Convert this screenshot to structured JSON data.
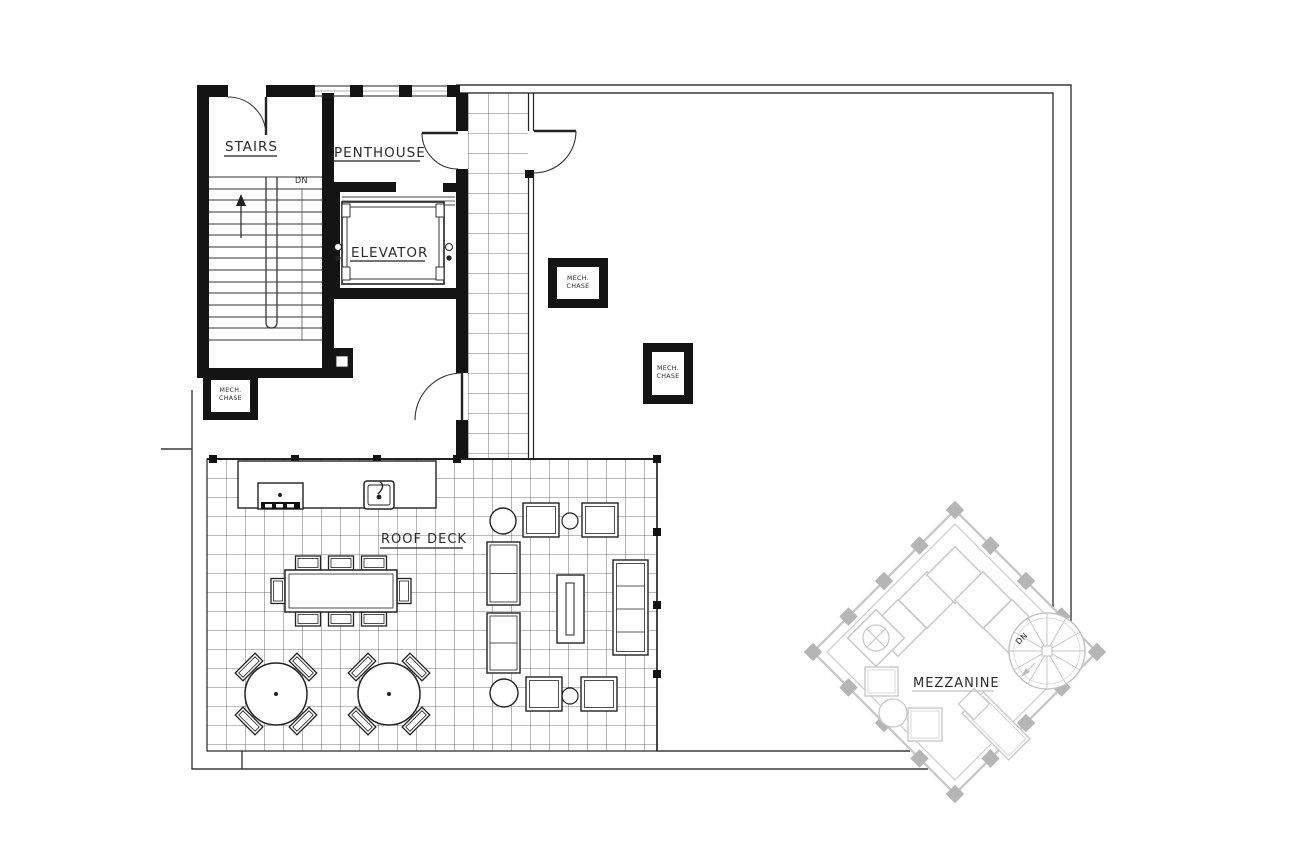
{
  "plan": {
    "labels": {
      "stairs": "STAIRS",
      "penthouse": "PENTHOUSE",
      "elevator": "ELEVATOR",
      "roof_deck": "ROOF DECK",
      "mezzanine": "MEZZANINE",
      "down_abbrev": "DN",
      "mezzanine_down_abbrev": "DN"
    },
    "mech_chase": {
      "line1": "MECH.",
      "line2": "CHASE"
    },
    "colors": {
      "ink": "#2a2a2a",
      "wall_fill": "#141414",
      "tile_line": "#4a4a4a",
      "mezzanine_line": "#c9c9c9",
      "mezzanine_column": "#b5b5b5",
      "background": "#ffffff"
    }
  }
}
